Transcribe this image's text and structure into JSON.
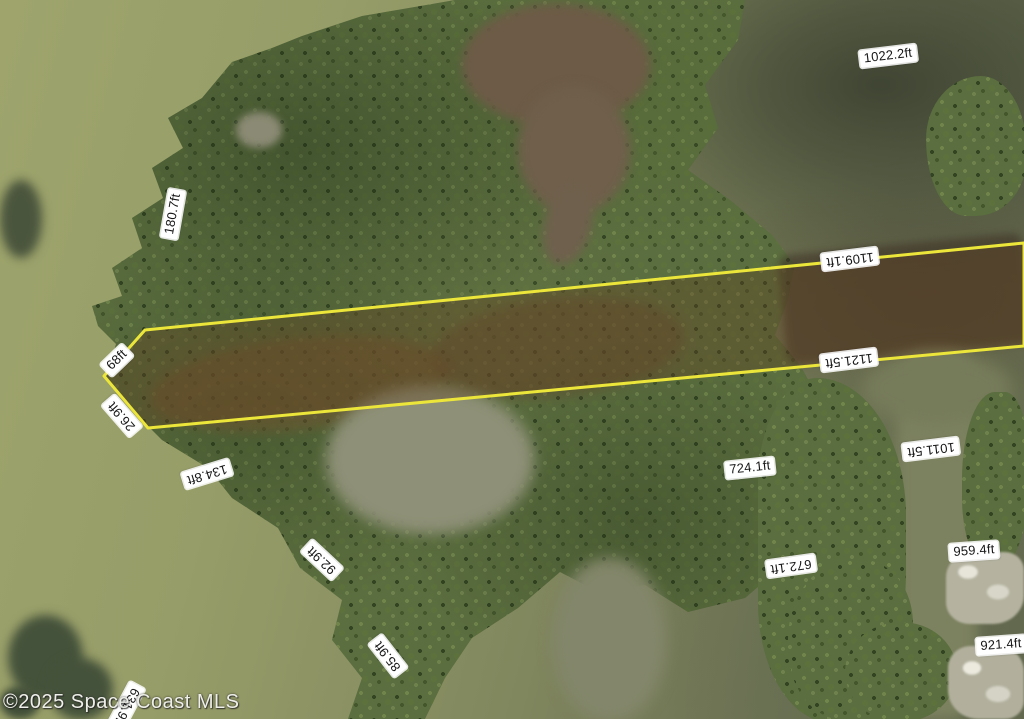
{
  "scene": {
    "type": "aerial-parcel-survey-photo",
    "watermark": "©2025 Space Coast MLS"
  },
  "colors": {
    "boundary_yellow": "#ece63b",
    "parcel_highlight_fill": "rgba(98,66,33,0.38)",
    "label_background": "#ffffff",
    "label_text": "#161616",
    "water_light_olive": "#9ea46c",
    "water_dark_olive": "#3a402f",
    "canopy_green": "#5b6e3f",
    "pond_brown": "#6d5b47",
    "pond_gray": "#8e9077",
    "dock_gray": "#b5b3a0"
  },
  "parcel": {
    "outline_points": "104,376 145,330 1024,243 1024,346 148,428",
    "stroke_width": 3
  },
  "measurements": [
    {
      "text": "1022.2ft",
      "x": 888,
      "y": 56,
      "rot": -7
    },
    {
      "text": "180.7ft",
      "x": 173,
      "y": 214,
      "rot": -80
    },
    {
      "text": "68ft",
      "x": 117,
      "y": 360,
      "rot": -44
    },
    {
      "text": "26.9ft",
      "x": 122,
      "y": 416,
      "rot": 229
    },
    {
      "text": "134.8ft",
      "x": 207,
      "y": 474,
      "rot": 163
    },
    {
      "text": "92.9ft",
      "x": 322,
      "y": 560,
      "rot": 223
    },
    {
      "text": "85.9ft",
      "x": 388,
      "y": 656,
      "rot": 232
    },
    {
      "text": "631.9ft",
      "x": 126,
      "y": 707,
      "rot": 118
    },
    {
      "text": "1109.1ft",
      "x": 850,
      "y": 259,
      "rot": 173
    },
    {
      "text": "1121.5ft",
      "x": 849,
      "y": 360,
      "rot": 173
    },
    {
      "text": "724.1ft",
      "x": 750,
      "y": 468,
      "rot": -6
    },
    {
      "text": "672.1ft",
      "x": 791,
      "y": 566,
      "rot": 172
    },
    {
      "text": "1011.5ft",
      "x": 931,
      "y": 449,
      "rot": 173
    },
    {
      "text": "959.4ft",
      "x": 974,
      "y": 551,
      "rot": -4
    },
    {
      "text": "921.4ft",
      "x": 1001,
      "y": 645,
      "rot": -4
    }
  ]
}
